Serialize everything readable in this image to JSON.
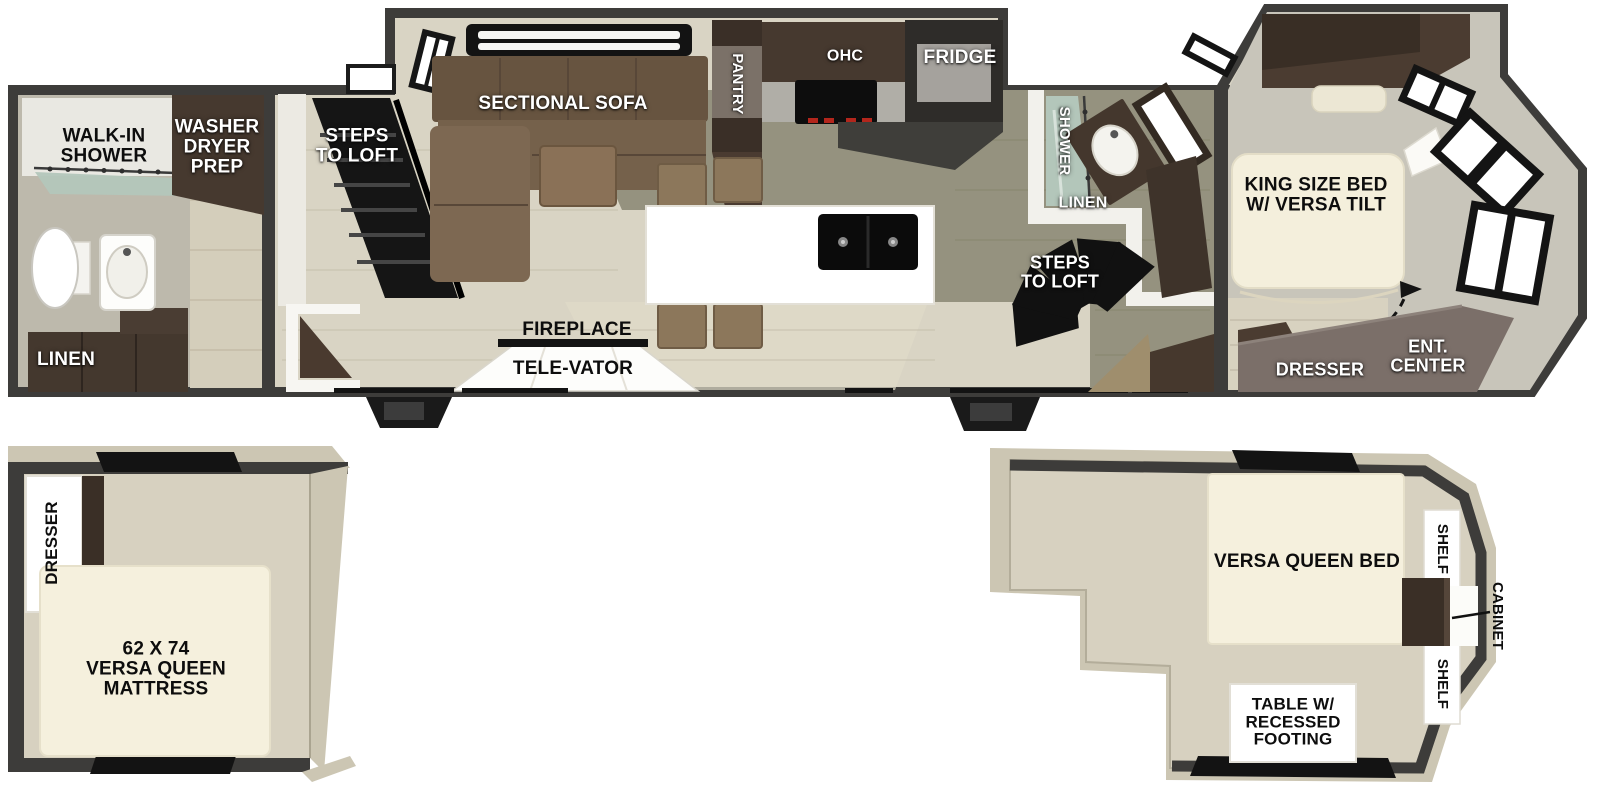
{
  "floorplan": {
    "type": "rv-travel-trailer-floorplan-with-two-lofts",
    "colors": {
      "exterior_wall": "#3d3c3a",
      "floor_beige": "#d9d4c4",
      "floor_gray_olive": "#95927f",
      "cabinet_dark_brown": "#3f332a",
      "sofa_brown": "#6f5b46",
      "bed_cream": "#f4efdc",
      "taupe_furniture": "#7b6f69",
      "shower_glass": "#b3c6ba",
      "loft_floor": "#d7d1c0",
      "label_white": "#ffffff",
      "label_black": "#0d0d0d"
    },
    "main_level": {
      "rear_bath": {
        "walk_in_shower": "WALK-IN\nSHOWER",
        "washer_dryer_prep": "WASHER\nDRYER\nPREP",
        "linen": "LINEN"
      },
      "living": {
        "steps_to_loft": "STEPS\nTO LOFT",
        "sectional_sofa": "SECTIONAL SOFA",
        "fireplace": "FIREPLACE",
        "tele_vator": "TELE-VATOR"
      },
      "kitchen": {
        "pantry": "PANTRY",
        "ohc": "OHC",
        "fridge": "FRIDGE"
      },
      "mid_bath": {
        "shower": "SHOWER",
        "linen": "LINEN",
        "steps_to_loft": "STEPS\nTO LOFT"
      },
      "bedroom": {
        "king_bed": "KING SIZE BED\nW/ VERSA TILT",
        "dresser": "DRESSER",
        "ent_center": "ENT.\nCENTER"
      }
    },
    "loft_left": {
      "dresser": "DRESSER",
      "mattress": "62 X 74\nVERSA QUEEN\nMATTRESS"
    },
    "loft_right": {
      "bed": "VERSA QUEEN BED",
      "shelf_top": "SHELF",
      "shelf_bottom": "SHELF",
      "cabinet": "CABINET",
      "table": "TABLE W/\nRECESSED\nFOOTING"
    }
  }
}
